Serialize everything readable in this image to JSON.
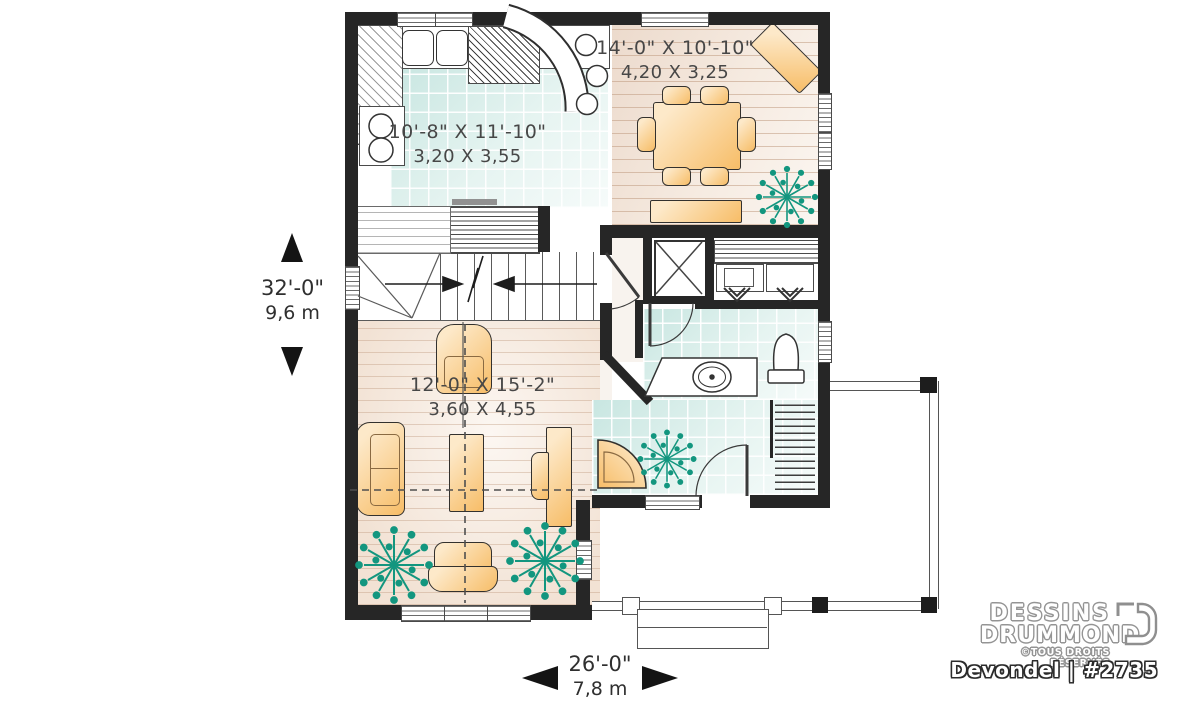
{
  "plan": {
    "rooms": {
      "dining": {
        "imperial": "14'-0\" X 10'-10\"",
        "metric": "4,20 X 3,25"
      },
      "kitchen": {
        "imperial": "10'-8\" X 11'-10\"",
        "metric": "3,20 X 3,55"
      },
      "living": {
        "imperial": "12'-0\" X 15'-2\"",
        "metric": "3,60 X 4,55"
      }
    },
    "overall": {
      "depth": {
        "imperial": "32'-0\"",
        "metric": "9,6 m"
      },
      "width": {
        "imperial": "26'-0\"",
        "metric": "7,8 m"
      }
    }
  },
  "branding": {
    "studio_line1": "DESSINS",
    "studio_line2": "DRUMMOND",
    "rights": "©TOUS DROITS RÉSERVÉS",
    "plan_title": "Devondel | #2735"
  },
  "colors": {
    "wall": "#262626",
    "tile": "#cfe8e4",
    "wood": "#f0dfd2",
    "furniture": "#f9c97e",
    "plant": "#13967f",
    "label_text": "#474747"
  }
}
